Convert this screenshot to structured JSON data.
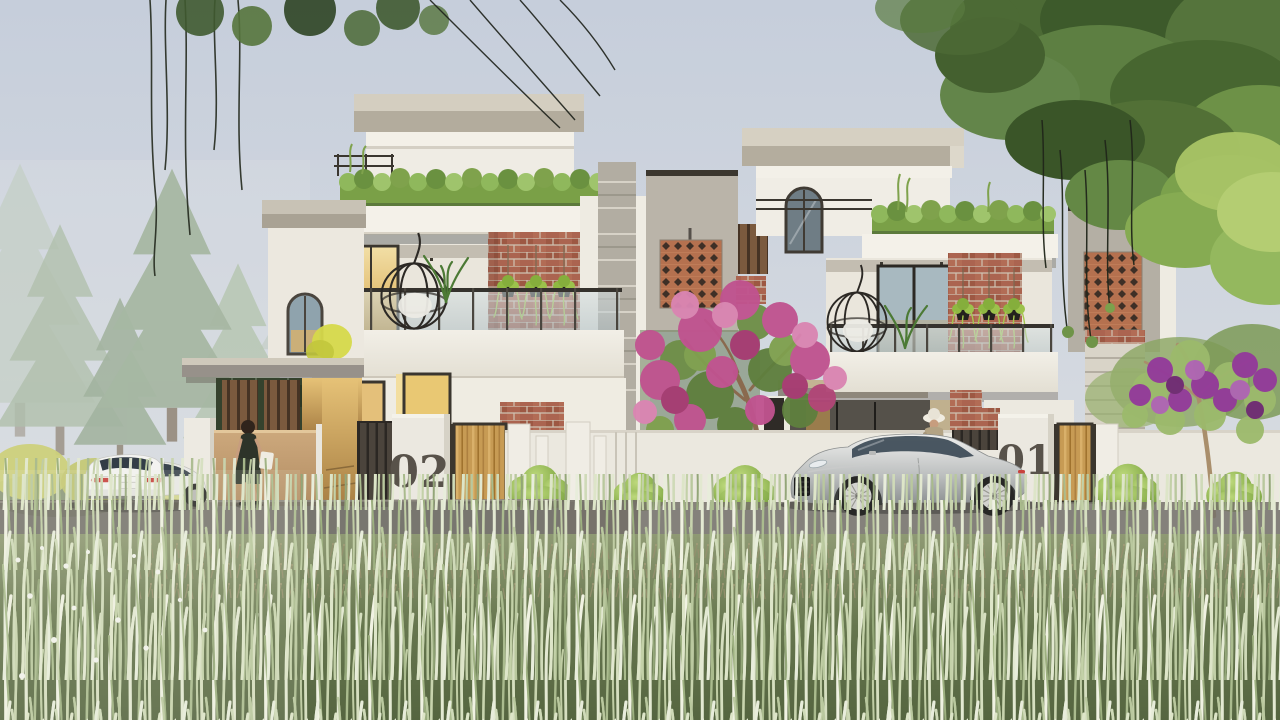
{
  "scene": {
    "title": "Twin modern villas exterior architectural visualization",
    "house_numbers": {
      "left": "02",
      "right": "01"
    }
  },
  "palette": {
    "sky": "#c9d1dc",
    "wall_white": "#f1eee6",
    "roof_slab": "#b3ac9d",
    "brick_accent": "#a9614b",
    "jali_terracotta": "#b5714f",
    "wood_gate": "#c79b54",
    "boundary_tan_wall": "#c7a377",
    "hedge_green": "#7fa24c",
    "grass_pale": "#dfe6c8",
    "car_silver": "#c9cbca",
    "car_white": "#f3f3f1",
    "bougainvillea_pink": "#c0538f",
    "flower_purple": "#93399b",
    "house_number_color": "#58524a"
  }
}
